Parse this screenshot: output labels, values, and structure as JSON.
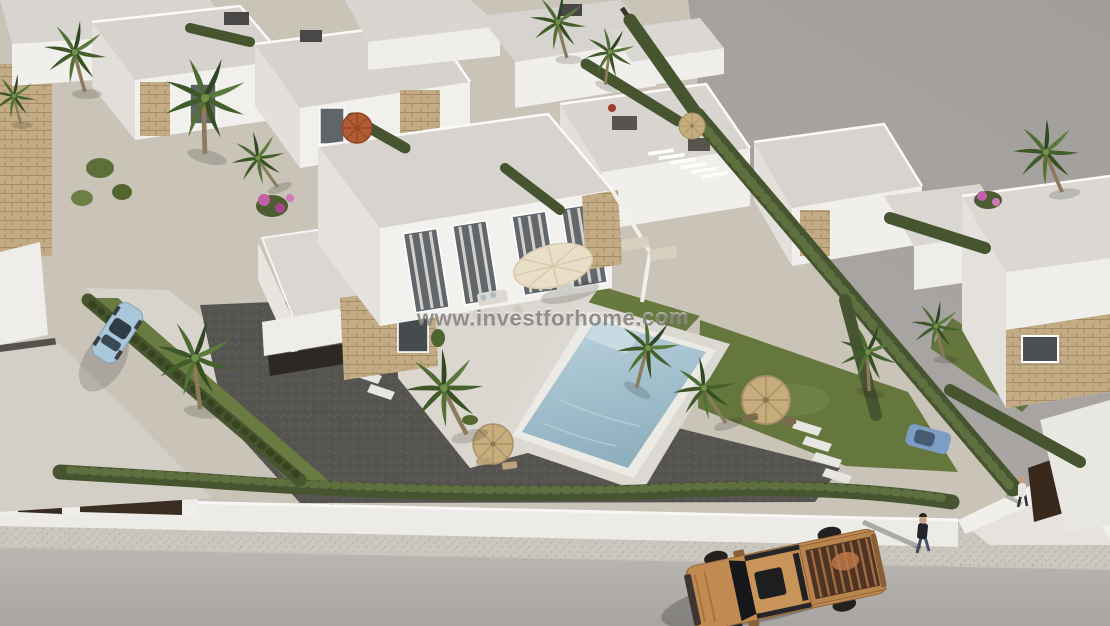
{
  "title": "aerial-villa-development-render",
  "watermark": {
    "text": "www.investforhome.com"
  },
  "scene": {
    "setting": "Aerial 3D architectural render of a modern residential development of white flat-roof villas with private pools, viewed from above a street",
    "objects": [
      "white flat-roof villas with tan stone accents",
      "central two-storey villa with terrace and cream parasol",
      "swimming pool with white coping",
      "palm trees",
      "cypress hedge rows",
      "white perimeter wall with dark brown gates",
      "gray road and sidewalk",
      "bronze pickup truck",
      "light blue parked car",
      "pedestrian on sidewalk",
      "person at gate",
      "straw parasols with seating",
      "terracotta garden umbrella",
      "dark gravel yards",
      "green lawns",
      "white stepping stones"
    ]
  },
  "palette": {
    "backdrop": "#a5a19e",
    "road": "#b0adaa",
    "sidewalk": "#cbc6be",
    "villa_white": "#f2f0ed",
    "roof_gray": "#d7d4d0",
    "stone_tan": "#c3ab86",
    "hedge_green": "#46542f",
    "lawn_green": "#68793f",
    "pool_blue": "#a4c0ce",
    "gravel_dark": "#565450",
    "truck_bronze": "#c08a50",
    "gate_brown": "#372b20",
    "car_blue": "#a9c6da"
  }
}
